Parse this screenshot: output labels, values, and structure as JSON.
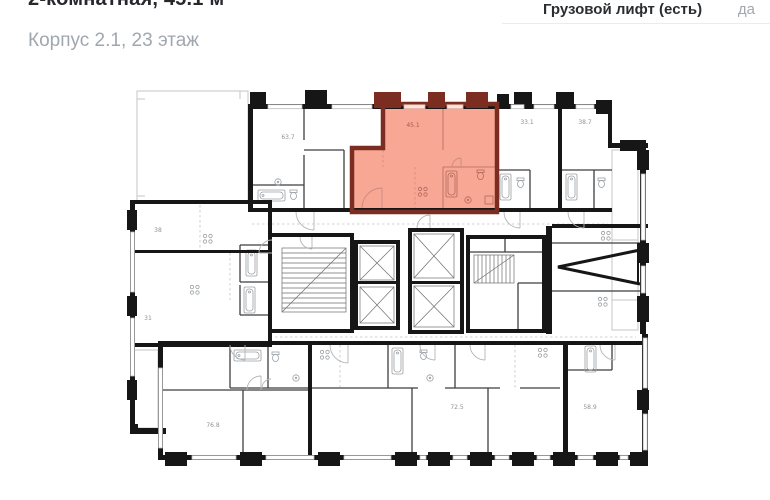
{
  "header": {
    "title": "2-комнатная, 45.1 м²",
    "subtitle": "Корпус 2.1, 23 этаж"
  },
  "details": {
    "label": "Грузовой лифт (есть)",
    "value": "да"
  },
  "floorplan": {
    "highlighted_unit": {
      "area": "45.1",
      "fill_color": "#f9a795",
      "wall_color": "#7c2d21"
    },
    "units": {
      "u637": "63.7",
      "u331": "33.1",
      "u387": "38.7",
      "u38": "38",
      "u31": "31",
      "u768": "76.8",
      "u725": "72.5",
      "u589": "58.9"
    },
    "colors": {
      "wall": "#161616",
      "background": "#ffffff"
    }
  }
}
